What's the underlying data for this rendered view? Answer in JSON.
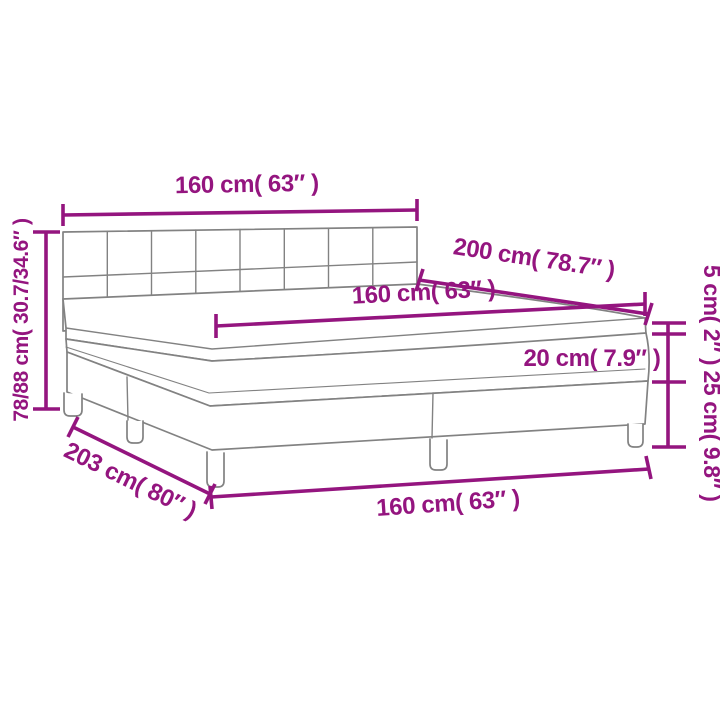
{
  "colors": {
    "dimension_accent": "#94157F",
    "drawing_outline": "#828282",
    "background": "#FFFFFF"
  },
  "dimensions": {
    "headboard_width": "160 cm( 63″ )",
    "bed_length": "200 cm( 78.7″ )",
    "mattress_width": "160 cm( 63″ )",
    "total_height_range": "78/88 cm( 30.7/34.6″ )",
    "topper_thickness": "5 cm( 2″ )",
    "mattress_thickness": "20 cm( 7.9″ )",
    "base_height": "25 cm( 9.8″ )",
    "total_length": "203 cm( 80″ )",
    "base_width": "160 cm( 63″ )"
  }
}
